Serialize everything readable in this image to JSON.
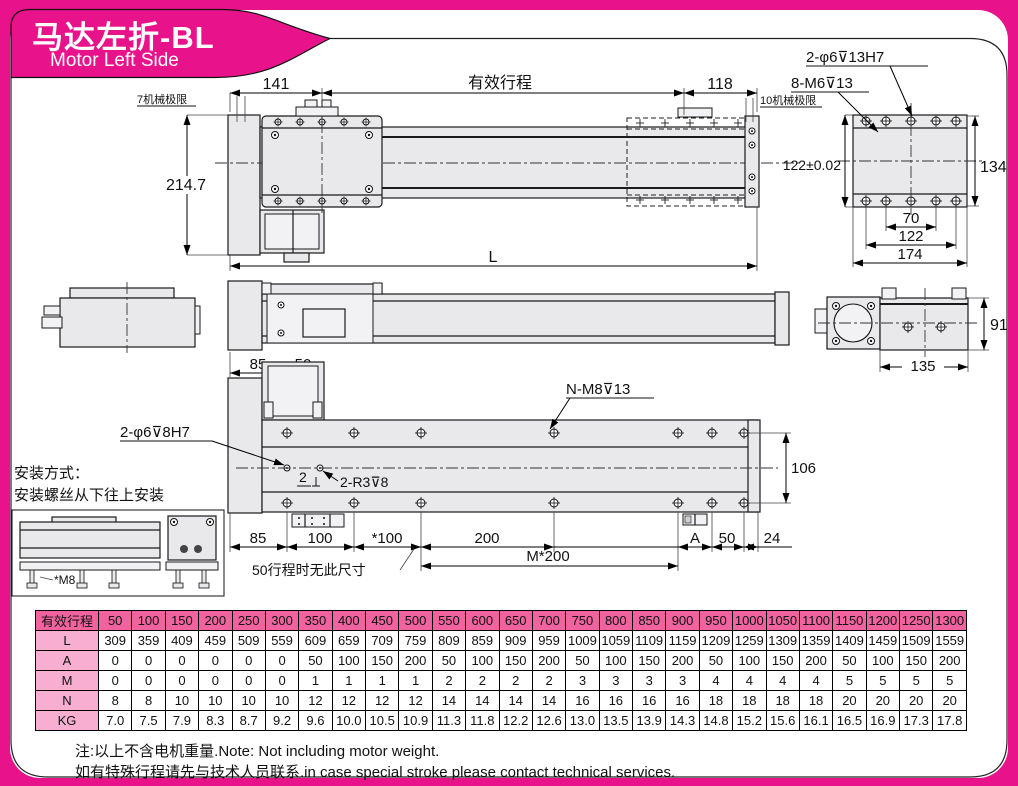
{
  "header": {
    "title_cn": "马达左折-BL",
    "title_en": "Motor Left Side"
  },
  "colors": {
    "banner_pink": "#e8128a",
    "table_header_pink": "#f0639f",
    "table_label_pink": "#f7aed0",
    "drawing_fill": "#e9e9ec",
    "line": "#1a1a1a"
  },
  "top_view": {
    "dim_141": "141",
    "stroke_label": "有效行程",
    "dim_118": "118",
    "mech_limit_left": "7机械极限",
    "mech_limit_right": "10机械极限",
    "dim_2147": "214.7",
    "dim_L": "L"
  },
  "carriage_view": {
    "label_dowel": "2-φ6⊽13H7",
    "label_tap": "8-M6⊽13",
    "dim_122tol": "122±0.02",
    "dim_134": "134",
    "dim_70": "70",
    "dim_122": "122",
    "dim_174": "174"
  },
  "side_view": {
    "dim_91": "91",
    "dim_135": "135",
    "dim_85": "85",
    "dim_50": "50"
  },
  "bottom_view": {
    "label_nm8": "N-M8⊽13",
    "label_dowel": "2-φ6⊽8H7",
    "dim_2": "2",
    "label_r3": "2-R3⊽8",
    "dim_106": "106",
    "dim_85": "85",
    "dim_100": "100",
    "dim_100s": "*100",
    "dim_200": "200",
    "dim_m200": "M*200",
    "dim_A": "A",
    "dim_50": "50",
    "dim_24": "24",
    "note_50": "50行程时无此尺寸"
  },
  "mounting": {
    "line1": "安装方式：",
    "line2": "安装螺丝从下往上安装",
    "label_m8": "*M8"
  },
  "table": {
    "row_labels": [
      "有效行程",
      "L",
      "A",
      "M",
      "N",
      "KG"
    ],
    "strokes": [
      "50",
      "100",
      "150",
      "200",
      "250",
      "300",
      "350",
      "400",
      "450",
      "500",
      "550",
      "600",
      "650",
      "700",
      "750",
      "800",
      "850",
      "900",
      "950",
      "1000",
      "1050",
      "1100",
      "1150",
      "1200",
      "1250",
      "1300"
    ],
    "L": [
      "309",
      "359",
      "409",
      "459",
      "509",
      "559",
      "609",
      "659",
      "709",
      "759",
      "809",
      "859",
      "909",
      "959",
      "1009",
      "1059",
      "1109",
      "1159",
      "1209",
      "1259",
      "1309",
      "1359",
      "1409",
      "1459",
      "1509",
      "1559"
    ],
    "A": [
      "0",
      "0",
      "0",
      "0",
      "0",
      "0",
      "50",
      "100",
      "150",
      "200",
      "50",
      "100",
      "150",
      "200",
      "50",
      "100",
      "150",
      "200",
      "50",
      "100",
      "150",
      "200",
      "50",
      "100",
      "150",
      "200"
    ],
    "M": [
      "0",
      "0",
      "0",
      "0",
      "0",
      "0",
      "1",
      "1",
      "1",
      "1",
      "2",
      "2",
      "2",
      "2",
      "3",
      "3",
      "3",
      "3",
      "4",
      "4",
      "4",
      "4",
      "5",
      "5",
      "5",
      "5"
    ],
    "N": [
      "8",
      "8",
      "10",
      "10",
      "10",
      "10",
      "12",
      "12",
      "12",
      "12",
      "14",
      "14",
      "14",
      "14",
      "16",
      "16",
      "16",
      "16",
      "18",
      "18",
      "18",
      "18",
      "20",
      "20",
      "20",
      "20"
    ],
    "KG": [
      "7.0",
      "7.5",
      "7.9",
      "8.3",
      "8.7",
      "9.2",
      "9.6",
      "10.0",
      "10.5",
      "10.9",
      "11.3",
      "11.8",
      "12.2",
      "12.6",
      "13.0",
      "13.5",
      "13.9",
      "14.3",
      "14.8",
      "15.2",
      "15.6",
      "16.1",
      "16.5",
      "16.9",
      "17.3",
      "17.8"
    ]
  },
  "notes": {
    "line1": "注:以上不含电机重量.Note: Not including motor weight.",
    "line2": "如有特殊行程请先与技术人员联系.in case special stroke please contact technical services."
  }
}
